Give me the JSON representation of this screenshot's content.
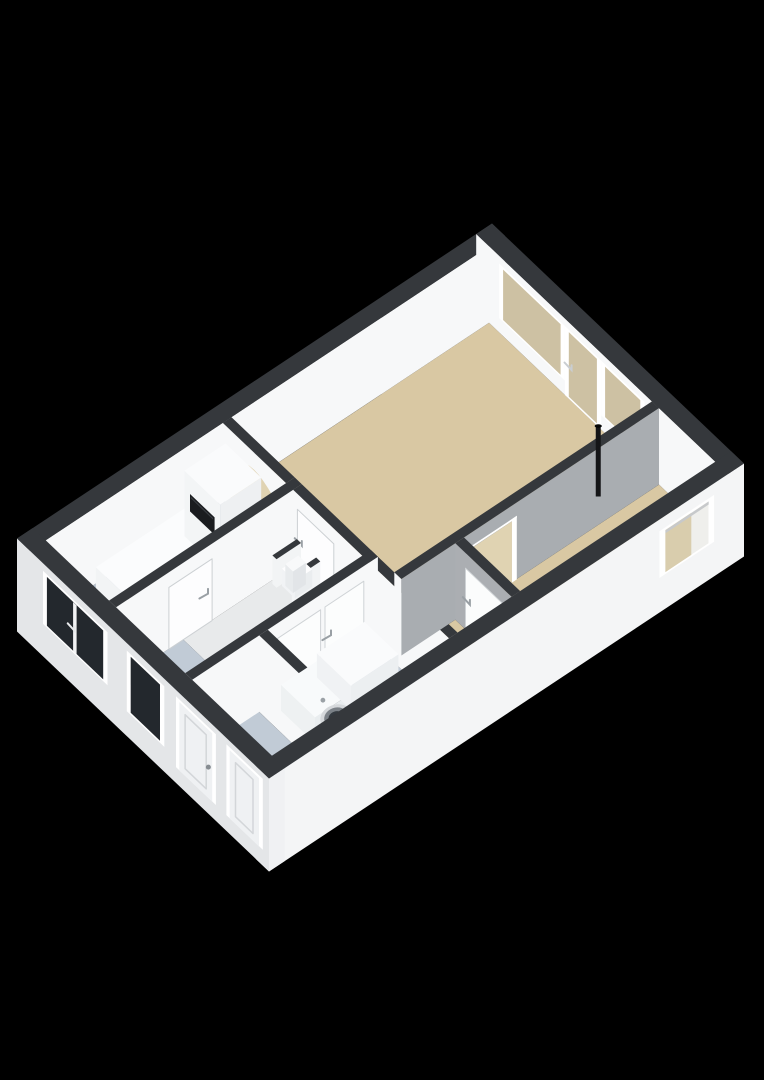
{
  "view": {
    "description": "3D isometric floor plan render, single floor, no visible text",
    "canvas": {
      "width": 764,
      "height": 1080,
      "background": "#000000"
    }
  },
  "palette": {
    "wall_top_band": "#35383c",
    "wall_white": "#f7f8f9",
    "wall_gray": "#a9adb1",
    "exterior_left": "#e4e6e8",
    "exterior_bright": "#f4f5f6",
    "floor_tan": "#d9c8a3",
    "floor_tan_light": "#e0d3b2",
    "floor_blue": "#b9c3cf",
    "floor_entry": "#c1cbd6",
    "floor_bath": "#c3cdd8",
    "floor_hall": "#e8eaeb",
    "glass_dark": "#23282d",
    "glass_tan": "#cdc1a3",
    "frame_white": "#ffffff",
    "oven_black": "#1a1c1f",
    "pipe_black": "#141517",
    "handle_gray": "#9aa0a5"
  },
  "projection": {
    "origin": [
      492,
      300
    ],
    "axisA": [
      -475,
      315
    ],
    "axisB": [
      252,
      240
    ],
    "planWidth": 6.6,
    "planDepth": 4.3,
    "pxPerMeterUp": 30,
    "wallHeight": 2.55,
    "slabDrop": 0.55
  },
  "elements": [
    {
      "t": "floor",
      "n": "living-room-floor",
      "x1": 2.68,
      "y1": 0.22,
      "x2": 6.38,
      "y2": 3.0,
      "c": "#d9c8a3"
    },
    {
      "t": "floor",
      "n": "kitchen-floor",
      "x1": 0.22,
      "y1": 0.22,
      "x2": 2.68,
      "y2": 1.3,
      "c": "#b9c3cf"
    },
    {
      "t": "floor",
      "n": "hallway-floor",
      "x1": 1.15,
      "y1": 1.42,
      "x2": 2.68,
      "y2": 2.6,
      "c": "#e8eaeb"
    },
    {
      "t": "floor",
      "n": "entry-floor",
      "x1": 0.22,
      "y1": 1.42,
      "x2": 1.15,
      "y2": 4.08,
      "c": "#c1cbd6"
    },
    {
      "t": "floor",
      "n": "bathroom-floor",
      "x1": 1.27,
      "y1": 2.72,
      "x2": 2.68,
      "y2": 4.08,
      "c": "#c3cdd8"
    },
    {
      "t": "floor",
      "n": "toilet-floor",
      "x1": 2.8,
      "y1": 3.12,
      "x2": 3.55,
      "y2": 4.08,
      "c": "#d9c8a3"
    },
    {
      "t": "floor",
      "n": "back-room-floor",
      "x1": 3.67,
      "y1": 3.12,
      "x2": 6.38,
      "y2": 4.08,
      "c": "#d9c8a3"
    },
    {
      "t": "wall",
      "n": "exterior-wall-top-left",
      "x1": 0,
      "y1": 0,
      "x2": 6.6,
      "y2": 0.22,
      "h": 2.55,
      "cL": "#e4e6e8",
      "cR": "#f7f8f9",
      "cT": "#35383c"
    },
    {
      "t": "wall",
      "n": "exterior-wall-top-right",
      "x1": 6.38,
      "y1": 0,
      "x2": 6.6,
      "y2": 4.3,
      "h": 2.55,
      "cL": "#f7f8f9",
      "cR": "#f4f5f6",
      "cT": "#35383c"
    },
    {
      "t": "frect",
      "n": "living-window-1-frame",
      "ax": "x",
      "at": 6.375,
      "a1": 0.4,
      "a2": 1.52,
      "z1": 0.5,
      "z2": 2.32,
      "c": "#ffffff"
    },
    {
      "t": "frect",
      "n": "living-window-1-glass",
      "ax": "x",
      "at": 6.372,
      "a1": 0.47,
      "a2": 1.45,
      "z1": 0.57,
      "z2": 2.25,
      "c": "#cdc1a3"
    },
    {
      "t": "frect",
      "n": "living-glass-door-frame",
      "ax": "x",
      "at": 6.375,
      "a1": 1.52,
      "a2": 2.14,
      "z1": 0.02,
      "z2": 2.32,
      "c": "#ffffff"
    },
    {
      "t": "frect",
      "n": "living-glass-door-glass",
      "ax": "x",
      "at": 6.372,
      "a1": 1.59,
      "a2": 2.07,
      "z1": 0.1,
      "z2": 2.25,
      "c": "#cdc1a3"
    },
    {
      "t": "tick",
      "n": "glass-door-handle",
      "ax": "x",
      "at": 6.37,
      "a": 1.64,
      "z": 1.08,
      "c": "#c9cdd1"
    },
    {
      "t": "frect",
      "n": "living-window-2-frame",
      "ax": "x",
      "at": 6.375,
      "a1": 2.14,
      "a2": 2.88,
      "z1": 0.5,
      "z2": 2.32,
      "c": "#ffffff"
    },
    {
      "t": "frect",
      "n": "living-window-2-glass",
      "ax": "x",
      "at": 6.372,
      "a1": 2.21,
      "a2": 2.81,
      "z1": 0.57,
      "z2": 2.25,
      "c": "#cdc1a3"
    },
    {
      "t": "wall",
      "n": "kitchen-living-arch-wall",
      "x1": 2.68,
      "y1": 0.22,
      "x2": 2.8,
      "y2": 1.3,
      "h": 2.55,
      "cL": "#f7f8f9",
      "cR": "#f7f8f9",
      "cT": "#35383c"
    },
    {
      "t": "arch",
      "n": "archway-opening",
      "at": 2.675,
      "a1": 0.36,
      "a2": 1.16,
      "zflat": 1.58,
      "zapex": 2.0,
      "c": "#e0d3b2"
    },
    {
      "t": "box",
      "n": "kitchen-counter",
      "x1": 0.82,
      "y1": 0.34,
      "x2": 2.05,
      "y2": 0.95,
      "h": 0.92,
      "cL": "#f2f4f5",
      "cR": "#eef0f2",
      "cT": "#fbfcfd"
    },
    {
      "t": "box",
      "n": "kitchen-tall-cabinet",
      "x1": 2.05,
      "y1": 0.34,
      "x2": 2.62,
      "y2": 0.95,
      "h": 2.18,
      "cL": "#f3f5f6",
      "cR": "#eef0f2",
      "cT": "#fafbfc"
    },
    {
      "t": "frect",
      "n": "built-in-oven",
      "ax": "x",
      "at": 2.045,
      "a1": 0.44,
      "a2": 0.86,
      "z1": 1.02,
      "z2": 1.6,
      "c": "#1a1c1f"
    },
    {
      "t": "frect",
      "n": "oven-handle",
      "ax": "x",
      "at": 2.04,
      "a1": 0.46,
      "a2": 0.84,
      "z1": 1.5,
      "z2": 1.55,
      "c": "#3a3e43"
    },
    {
      "t": "wall",
      "n": "kitchen-hall-wall",
      "x1": 0.22,
      "y1": 1.3,
      "x2": 2.8,
      "y2": 1.42,
      "h": 2.55,
      "cL": "#f7f8f9",
      "cR": "#f7f8f9",
      "cT": "#35383c"
    },
    {
      "t": "frect",
      "n": "hall-door-1-leaf",
      "ax": "y",
      "at": 1.425,
      "a1": 0.95,
      "a2": 1.55,
      "z1": 0,
      "z2": 2.06,
      "c": "#fdfdfe",
      "sc": "#ccd0d3",
      "sw": 1
    },
    {
      "t": "tick",
      "n": "hall-door-1-handle",
      "ax": "y",
      "at": 1.43,
      "a": 1.49,
      "z": 1.0,
      "c": "#9aa0a5"
    },
    {
      "t": "wall",
      "n": "hall-living-wall",
      "x1": 2.68,
      "y1": 1.42,
      "x2": 2.8,
      "y2": 4.08,
      "h": 2.55,
      "cL": "#f7f8f9",
      "cR": "#f7f8f9",
      "cT": "#35383c"
    },
    {
      "t": "frect",
      "n": "hall-door-2-leaf",
      "ax": "x",
      "at": 2.675,
      "a1": 1.5,
      "a2": 2.12,
      "z1": 0,
      "z2": 2.06,
      "c": "#fdfdfe",
      "sc": "#ccd0d3",
      "sw": 1
    },
    {
      "t": "tick",
      "n": "hall-door-2-handle",
      "ax": "x",
      "at": 2.67,
      "a": 1.58,
      "z": 1.0,
      "c": "#9aa0a5"
    },
    {
      "t": "wall",
      "n": "niche-wall-a",
      "x1": 2.36,
      "y1": 1.46,
      "x2": 2.7,
      "y2": 1.53,
      "h": 0.95,
      "cL": "#f2f4f5",
      "cR": "#f2f4f5",
      "cT": "#35383c"
    },
    {
      "t": "wall",
      "n": "niche-wall-b",
      "x1": 2.36,
      "y1": 1.79,
      "x2": 2.7,
      "y2": 1.86,
      "h": 0.95,
      "cL": "#f2f4f5",
      "cR": "#f2f4f5",
      "cT": "#35383c"
    },
    {
      "t": "box",
      "n": "niche-appliance",
      "x1": 2.42,
      "y1": 1.55,
      "x2": 2.66,
      "y2": 1.77,
      "h": 0.58,
      "cL": "#f1f3f5",
      "cR": "#eaedef",
      "cT": "#fdfdfe"
    },
    {
      "t": "box",
      "n": "niche-appliance-lid",
      "x1": 2.45,
      "y1": 1.57,
      "x2": 2.63,
      "y2": 1.7,
      "h": 0.72,
      "cL": "#e8ebed",
      "cR": "#e2e5e8",
      "cT": "#f8f9fa"
    },
    {
      "t": "wall",
      "n": "bathroom-hall-wall",
      "x1": 0.22,
      "y1": 2.6,
      "x2": 2.8,
      "y2": 2.72,
      "h": 2.55,
      "cL": "#f7f8f9",
      "cR": "#f7f8f9",
      "cT": "#35383c"
    },
    {
      "t": "frect",
      "n": "bathroom-door-leaf",
      "ax": "y",
      "at": 2.725,
      "a1": 1.4,
      "a2": 2.0,
      "z1": 0,
      "z2": 2.06,
      "c": "#fcfdfd",
      "sc": "#cfd3d6",
      "sw": 1
    },
    {
      "t": "tick",
      "n": "bathroom-door-handle",
      "ax": "y",
      "at": 2.73,
      "a": 1.5,
      "z": 1.0,
      "c": "#9aa0a5"
    },
    {
      "t": "frect",
      "n": "hall-door-3-leaf",
      "ax": "y",
      "at": 2.725,
      "a1": 2.06,
      "a2": 2.6,
      "z1": 0,
      "z2": 2.06,
      "c": "#fcfdfd",
      "sc": "#cfd3d6",
      "sw": 1
    },
    {
      "t": "tick",
      "n": "hall-door-3-handle",
      "ax": "y",
      "at": 2.73,
      "a": 2.14,
      "z": 1.0,
      "c": "#9aa0a5"
    },
    {
      "t": "wall",
      "n": "entry-bathroom-wall",
      "x1": 1.15,
      "y1": 2.72,
      "x2": 1.27,
      "y2": 4.08,
      "h": 2.55,
      "cL": "#f7f8f9",
      "cR": "#f7f8f9",
      "cT": "#35383c"
    },
    {
      "t": "wall",
      "n": "living-back-wall",
      "x1": 2.8,
      "y1": 3.0,
      "x2": 6.38,
      "y2": 3.12,
      "h": 2.55,
      "cL": "#f7f8f9",
      "cR": "#a9adb1",
      "cT": "#35383c"
    },
    {
      "t": "frect",
      "n": "back-door-frame-left",
      "ax": "y",
      "at": 3.125,
      "a1": 3.7,
      "a2": 3.77,
      "z1": 0,
      "z2": 2.12,
      "c": "#ffffff"
    },
    {
      "t": "frect",
      "n": "back-door-frame-right",
      "ax": "y",
      "at": 3.125,
      "a1": 4.33,
      "a2": 4.4,
      "z1": 0,
      "z2": 2.12,
      "c": "#ffffff"
    },
    {
      "t": "frect",
      "n": "back-door-frame-top",
      "ax": "y",
      "at": 3.125,
      "a1": 3.7,
      "a2": 4.4,
      "z1": 2.05,
      "z2": 2.12,
      "c": "#ffffff"
    },
    {
      "t": "frect",
      "n": "back-door-opening",
      "ax": "y",
      "at": 3.128,
      "a1": 3.77,
      "a2": 4.33,
      "z1": 0,
      "z2": 2.05,
      "c": "#e0d3b2"
    },
    {
      "t": "wall",
      "n": "toilet-backroom-wall",
      "x1": 3.55,
      "y1": 3.12,
      "x2": 3.67,
      "y2": 4.08,
      "h": 2.55,
      "cL": "#abaeb2",
      "cR": "#b4b7bb",
      "cT": "#35383c"
    },
    {
      "t": "frect",
      "n": "toilet-door-leaf",
      "ax": "x",
      "at": 3.545,
      "a1": 3.3,
      "a2": 3.92,
      "z1": 0,
      "z2": 2.06,
      "c": "#fbfcfc",
      "sc": "#ced2d5",
      "sw": 1
    },
    {
      "t": "tick",
      "n": "toilet-door-handle",
      "ax": "x",
      "at": 3.54,
      "a": 3.38,
      "z": 1.0,
      "c": "#9aa0a5"
    },
    {
      "t": "pipe",
      "n": "stove-flue-pipe",
      "x": 5.78,
      "y": 2.82,
      "h": 2.35,
      "c": "#141517"
    },
    {
      "t": "box",
      "n": "washing-machine",
      "x1": 1.34,
      "y1": 2.86,
      "x2": 1.92,
      "y2": 3.44,
      "h": 0.86,
      "cL": "#eef1f2",
      "cR": "#e9edef",
      "cT": "#f8fafb"
    },
    {
      "t": "wdoor",
      "n": "washing-machine-door",
      "x": 1.63,
      "y": 3.44,
      "z": 0.4
    },
    {
      "t": "box",
      "n": "bathroom-counter-box",
      "x1": 1.92,
      "y1": 2.76,
      "x2": 2.58,
      "y2": 3.34,
      "h": 0.8,
      "cL": "#f0f2f4",
      "cR": "#ecefF1",
      "cT": "#fafbfc"
    },
    {
      "t": "wall",
      "n": "exterior-wall-bottom-right",
      "x1": 0,
      "y1": 4.08,
      "x2": 6.6,
      "y2": 4.3,
      "h": 2.55,
      "zb": -0.55,
      "cL": "#f7f8f9",
      "cR": "#f4f5f6",
      "cT": "#35383c"
    },
    {
      "t": "frect",
      "n": "back-window-frame",
      "ax": "y",
      "at": 4.305,
      "a1": 5.42,
      "a2": 6.18,
      "z1": 0.62,
      "z2": 2.18,
      "c": "#ffffff"
    },
    {
      "t": "frect",
      "n": "back-window-jamb",
      "ax": "y",
      "at": 4.308,
      "a1": 5.5,
      "a2": 6.1,
      "z1": 0.7,
      "z2": 2.1,
      "c": "#efefec"
    },
    {
      "t": "frect",
      "n": "back-window-glass-left",
      "ax": "y",
      "at": 4.31,
      "a1": 5.5,
      "a2": 5.86,
      "z1": 0.7,
      "z2": 2.1,
      "c": "#d9cdad"
    },
    {
      "t": "frect",
      "n": "back-window-shadow",
      "ax": "y",
      "at": 4.312,
      "a1": 5.5,
      "a2": 6.1,
      "z1": 2.0,
      "z2": 2.1,
      "c": "#c7c9cb"
    },
    {
      "t": "wall",
      "n": "exterior-wall-bottom-left",
      "x1": 0,
      "y1": 0,
      "x2": 0.22,
      "y2": 4.3,
      "h": 2.55,
      "zb": -0.55,
      "cL": "#e4e6e8",
      "cR": "#f0f1f3",
      "cT": "#35383c"
    },
    {
      "t": "frect",
      "n": "kitchen-window-frame",
      "ax": "x",
      "at": -0.005,
      "a1": 0.45,
      "a2": 1.55,
      "z1": 0.55,
      "z2": 2.32,
      "c": "#ffffff"
    },
    {
      "t": "frect",
      "n": "kitchen-window-glass",
      "ax": "x",
      "at": -0.008,
      "a1": 0.52,
      "a2": 1.48,
      "z1": 0.62,
      "z2": 2.25,
      "c": "#23282d"
    },
    {
      "t": "frect",
      "n": "kitchen-window-mullion",
      "ax": "x",
      "at": -0.01,
      "a1": 0.97,
      "a2": 1.03,
      "z1": 0.62,
      "z2": 2.25,
      "c": "#f2f3f4"
    },
    {
      "t": "tick",
      "n": "kitchen-window-handle",
      "ax": "x",
      "at": -0.012,
      "a": 1.0,
      "z": 1.35,
      "c": "#e8eaec"
    },
    {
      "t": "frect",
      "n": "entry-window-frame",
      "ax": "x",
      "at": -0.005,
      "a1": 1.88,
      "a2": 2.52,
      "z1": 0.3,
      "z2": 2.32,
      "c": "#ffffff"
    },
    {
      "t": "frect",
      "n": "entry-window-glass",
      "ax": "x",
      "at": -0.008,
      "a1": 1.95,
      "a2": 2.45,
      "z1": 0.38,
      "z2": 2.25,
      "c": "#23282d"
    },
    {
      "t": "frect",
      "n": "front-door-frame",
      "ax": "x",
      "at": -0.005,
      "a1": 2.72,
      "a2": 3.4,
      "z1": 0,
      "z2": 2.36,
      "c": "#ffffff"
    },
    {
      "t": "frect",
      "n": "front-door-leaf",
      "ax": "x",
      "at": -0.008,
      "a1": 2.78,
      "a2": 3.34,
      "z1": 0,
      "z2": 2.28,
      "c": "#eff1f3"
    },
    {
      "t": "frect",
      "n": "front-door-panel",
      "ax": "x",
      "at": -0.01,
      "a1": 2.88,
      "a2": 3.24,
      "z1": 0.25,
      "z2": 2.05,
      "c": "none",
      "sc": "#d3d6d9",
      "sw": 1.5
    },
    {
      "t": "dot",
      "n": "front-door-handle",
      "ax": "x",
      "at": -0.012,
      "a": 3.28,
      "z": 1.05,
      "r": 2.5,
      "c": "#868c91"
    },
    {
      "t": "frect",
      "n": "storage-door-frame",
      "ax": "x",
      "at": -0.005,
      "a1": 3.58,
      "a2": 4.2,
      "z1": 0,
      "z2": 2.36,
      "c": "#ffffff"
    },
    {
      "t": "frect",
      "n": "storage-door-leaf",
      "ax": "x",
      "at": -0.008,
      "a1": 3.64,
      "a2": 4.14,
      "z1": 0,
      "z2": 2.28,
      "c": "#eff1f3"
    },
    {
      "t": "frect",
      "n": "storage-door-panel",
      "ax": "x",
      "at": -0.01,
      "a1": 3.74,
      "a2": 4.04,
      "z1": 0.25,
      "z2": 2.05,
      "c": "none",
      "sc": "#d3d6d9",
      "sw": 1.5
    }
  ]
}
